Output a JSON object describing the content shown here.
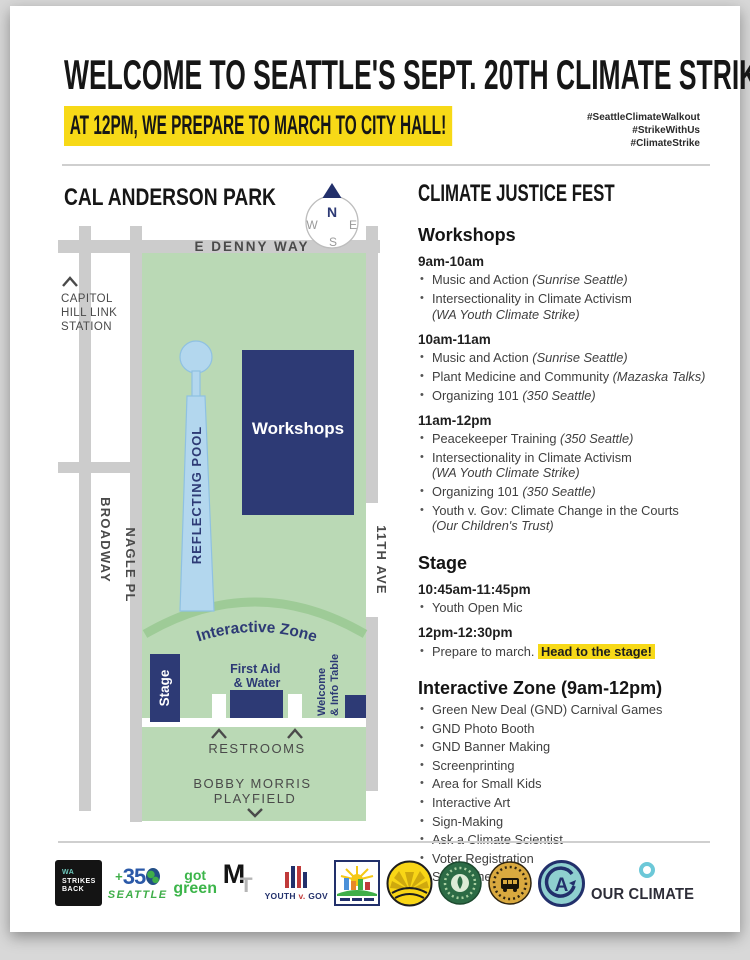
{
  "header": {
    "title": "WELCOME TO SEATTLE'S SEPT. 20TH CLIMATE STRIKE!",
    "subtitle": "AT 12PM, WE PREPARE TO MARCH TO CITY HALL!",
    "hashtags": [
      "#SeattleClimateWalkout",
      "#StrikeWithUs",
      "#ClimateStrike"
    ]
  },
  "map": {
    "title": "CAL ANDERSON PARK",
    "compass": {
      "n": "N",
      "w": "W",
      "e": "E",
      "s": "S"
    },
    "streets": {
      "denny": "E DENNY WAY",
      "broadway": "BROADWAY",
      "nagle": "NAGLE PL",
      "eleventh": "11TH AVE"
    },
    "station_lines": [
      "CAPITOL",
      "HILL LINK",
      "STATION"
    ],
    "pool_label": "REFLECTING POOL",
    "workshops_label": "Workshops",
    "interactive_zone_label": "Interactive Zone",
    "stage_label": "Stage",
    "first_aid_lines": [
      "First Aid",
      "& Water"
    ],
    "welcome_lines": [
      "Welcome",
      "& Info Table"
    ],
    "restrooms_label": "RESTROOMS",
    "playfield_lines": [
      "BOBBY MORRIS",
      "PLAYFIELD"
    ]
  },
  "schedule": {
    "title": "CLIMATE JUSTICE FEST",
    "sections": [
      {
        "heading": "Workshops",
        "slots": [
          {
            "time": "9am-10am",
            "items": [
              {
                "text": "Music and Action",
                "org": "(Sunrise Seattle)"
              },
              {
                "text": "Intersectionality in Climate Activism",
                "org": "(WA Youth Climate Strike)",
                "org_newline": true
              }
            ]
          },
          {
            "time": "10am-11am",
            "items": [
              {
                "text": "Music and Action",
                "org": "(Sunrise Seattle)"
              },
              {
                "text": "Plant Medicine and Community",
                "org": "(Mazaska Talks)"
              },
              {
                "text": "Organizing 101",
                "org": "(350 Seattle)"
              }
            ]
          },
          {
            "time": "11am-12pm",
            "items": [
              {
                "text": "Peacekeeper Training",
                "org": "(350 Seattle)"
              },
              {
                "text": "Intersectionality in Climate Activism",
                "org": "(WA Youth Climate Strike)",
                "org_newline": true
              },
              {
                "text": "Organizing 101",
                "org": "(350 Seattle)"
              },
              {
                "text": "Youth v. Gov: Climate Change in the Courts",
                "org": "(Our Children's Trust)",
                "org_newline": true
              }
            ]
          }
        ]
      },
      {
        "heading": "Stage",
        "slots": [
          {
            "time": "10:45am-11:45pm",
            "items": [
              {
                "text": "Youth Open Mic"
              }
            ]
          },
          {
            "time": "12pm-12:30pm",
            "items": [
              {
                "text": "Prepare to march.",
                "highlight": "Head to the stage!"
              }
            ]
          }
        ]
      },
      {
        "heading": "Interactive Zone (9am-12pm)",
        "slots": [
          {
            "time": "",
            "items": [
              {
                "text": "Green New Deal (GND) Carnival Games"
              },
              {
                "text": "GND Photo Booth"
              },
              {
                "text": "GND Banner Making"
              },
              {
                "text": "Screenprinting"
              },
              {
                "text": "Area for Small Kids"
              },
              {
                "text": "Interactive Art"
              },
              {
                "text": "Sign-Making"
              },
              {
                "text": "Ask a Climate Scientist"
              },
              {
                "text": "Voter Registration"
              },
              {
                "text": "Street Theater"
              }
            ]
          }
        ]
      }
    ]
  },
  "logos": [
    {
      "name": "wa-strikes-back",
      "lines": [
        "WA",
        "STRIKES",
        "BACK"
      ]
    },
    {
      "name": "350-seattle",
      "plus": "+",
      "num": "35",
      "city": "SEATTLE"
    },
    {
      "name": "got-green",
      "lines": [
        "got",
        "green"
      ]
    },
    {
      "name": "mazaska-mt-monogram",
      "m": "M",
      "t": "T"
    },
    {
      "name": "youth-v-gov",
      "word1": "YOUTH",
      "word2": "v.",
      "word3": "GOV"
    },
    {
      "name": "climate-city-badge"
    },
    {
      "name": "sunrise-movement-badge"
    },
    {
      "name": "green-seal-badge"
    },
    {
      "name": "transit-riders-union-badge"
    },
    {
      "name": "ca-monogram-badge"
    },
    {
      "name": "our-climate",
      "label": "OUR CLIMATE"
    }
  ],
  "colors": {
    "navy": "#2d3a75",
    "park_green": "#bad9b5",
    "arc_green": "#9ecb97",
    "pool_blue": "#b3d7ee",
    "street_gray": "#cccccc",
    "highlight_yellow": "#f7d917"
  }
}
